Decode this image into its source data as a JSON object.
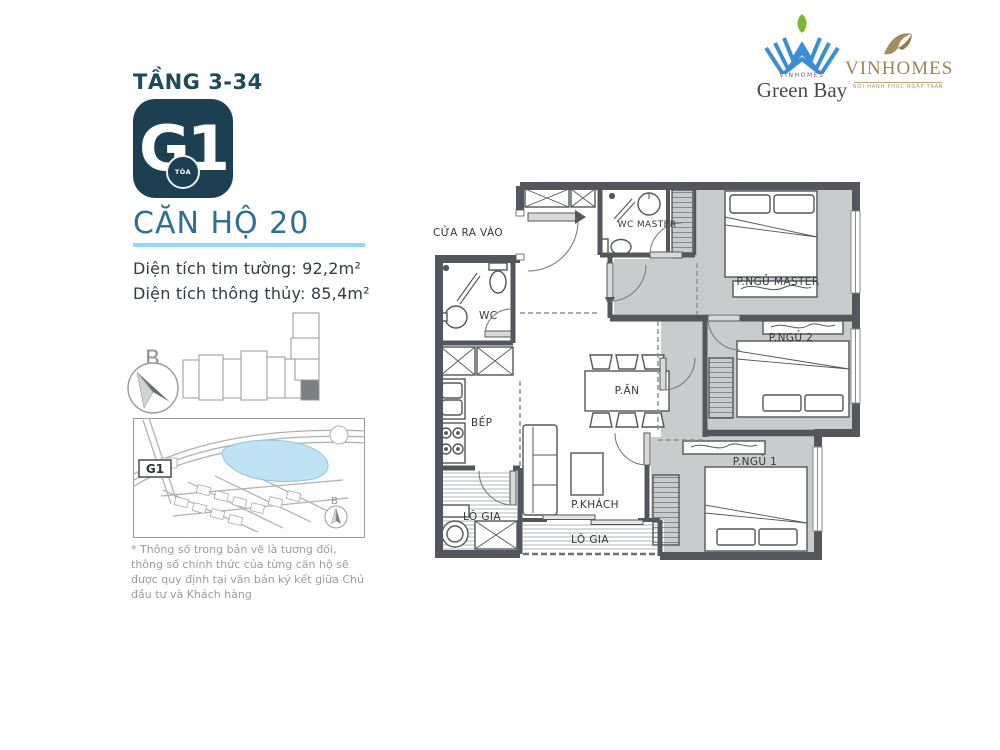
{
  "header": {
    "floor_label": "TẦNG 3-34",
    "badge": {
      "code": "G1",
      "tower": "TÒA"
    },
    "unit_title": "CĂN HỘ 20",
    "area_lines": [
      "Diện tích tim tường: 92,2m²",
      "Diện tích thông thủy: 85,4m²"
    ]
  },
  "logos": {
    "green_bay": {
      "brand": "VINHOMES",
      "name": "Green Bay"
    },
    "vinhomes": {
      "name": "VINHOMES",
      "tagline": "NƠI HẠNH PHÚC NGẬP TRÀN"
    }
  },
  "locator": {
    "compass_letter": "B",
    "map_unit_label": "G1",
    "map_compass_letter": "B"
  },
  "plan": {
    "entrance": "CỬA RA VÀO",
    "wc": "WC",
    "wc_master": "WC MASTER",
    "bedroom_master": "P.NGỦ MASTER",
    "bedroom_2": "P.NGỦ 2",
    "bedroom_1": "P.NGỦ 1",
    "dining": "P.ĂN",
    "kitchen": "BẾP",
    "living": "P.KHÁCH",
    "loggia_1": "LÔ GIA",
    "loggia_2": "LÔ GIA"
  },
  "footnote": "* Thông số trong bản vẽ là tương đối, thông số chính thức của từng căn hộ sẽ được quy định tại văn bản ký kết giữa Chủ đầu tư và Khách hàng",
  "colors": {
    "accent_dark_teal": "#1c4051",
    "title_blue": "#2f7090",
    "underline_cyan": "#8ed9f6",
    "wall_gray": "#54565b",
    "room_floor_gray": "#cacbcd",
    "lake_blue": "#bfe3f4",
    "logo_blue": "#3b8ed6",
    "logo_green": "#7cb82f",
    "logo_gold": "#9b8659"
  }
}
